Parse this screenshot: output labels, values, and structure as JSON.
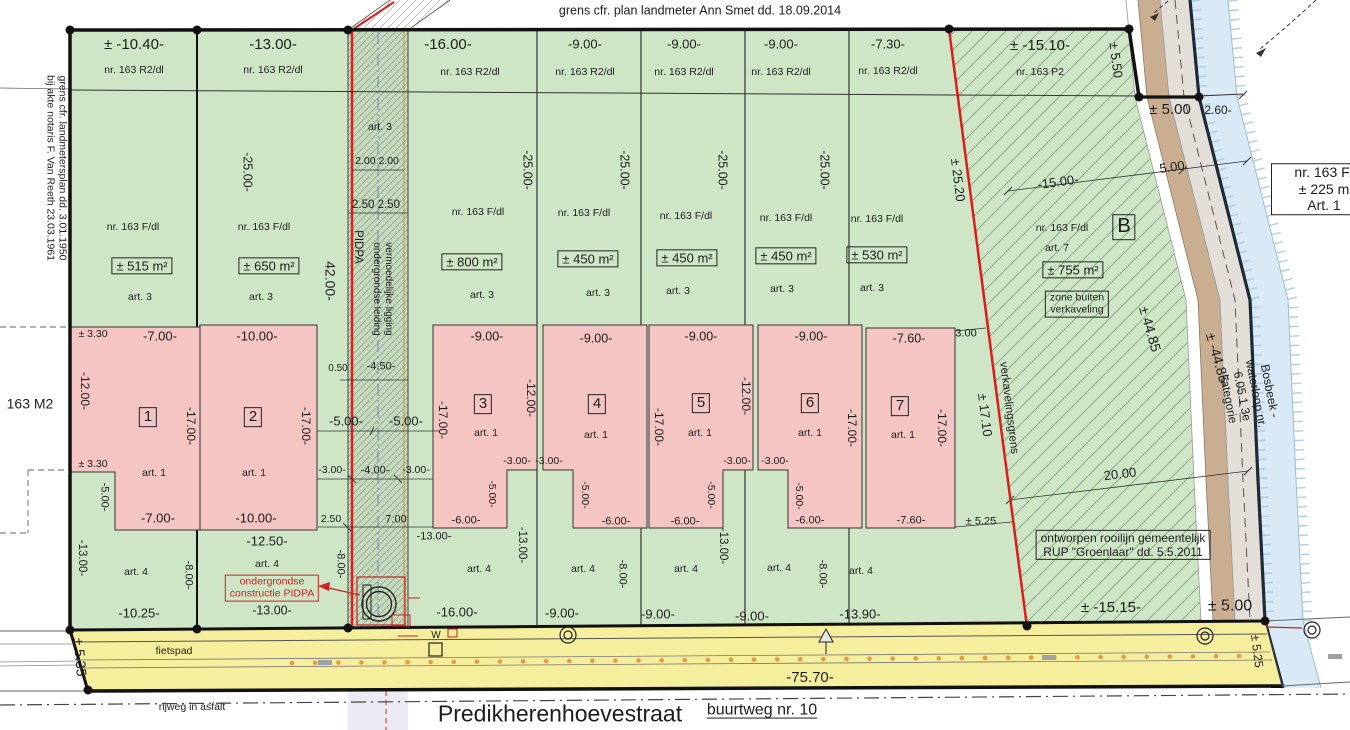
{
  "title": "verkavelingsplan Predikherenhoevestraat",
  "street": {
    "name": "Predikherenhoevestraat",
    "buurtweg": "buurtweg nr. 10",
    "fietspad": "fietspad",
    "rijweg": "rijweg in asfalt",
    "road_length_label": "-75.70-"
  },
  "notes": {
    "top_boundary": "grens cfr. plan landmeter Ann Smet dd. 18.09.2014",
    "left_boundary": "grens cfr. landmetersplan dd. 3.01.1950 bij akte notaris F. Van Reeth 23.03.1961",
    "rooilijn": "ontworpen rooilijn gemeentelijk RUP \"Groenlaar\" dd. 5.5.2011",
    "pidpa_construction": "ondergrondse constructie PIDPA",
    "pidpa_strip": "vermoedelijke ligging ondergrondse leiding PIDPA",
    "waterway": "Bosbeek - waterloop nr. 6.05.1 3e kategorie",
    "subdivision_boundary": "verkavelingsgrens",
    "zone_b": "zone buiten verkaveling"
  },
  "parcels": [
    {
      "lot": "1",
      "area": "± 515 m²",
      "cadastral": "nr. 163 R2/dl / nr. 163 F/dl",
      "front_width": "± -10.40-",
      "house_zoning": "art. 1"
    },
    {
      "lot": "2",
      "area": "± 650 m²",
      "cadastral": "nr. 163 R2/dl / nr. 163 F/dl",
      "front_width": "-13.00-",
      "house_zoning": "art. 1"
    },
    {
      "lot": "3",
      "area": "± 800 m²",
      "cadastral": "nr. 163 R2/dl / nr. 163 F/dl",
      "front_width": "-16.00-",
      "house_zoning": "art. 1"
    },
    {
      "lot": "4",
      "area": "± 450 m²",
      "cadastral": "nr. 163 R2/dl / nr. 163 F/dl",
      "front_width": "-9.00-",
      "house_zoning": "art. 1"
    },
    {
      "lot": "5",
      "area": "± 450 m²",
      "cadastral": "nr. 163 R2/dl / nr. 163 F/dl",
      "front_width": "-9.00-",
      "house_zoning": "art. 1"
    },
    {
      "lot": "6",
      "area": "± 450 m²",
      "cadastral": "nr. 163 R2/dl / nr. 163 F/dl",
      "front_width": "-9.00-",
      "house_zoning": "art. 1"
    },
    {
      "lot": "7",
      "area": "± 530 m²",
      "cadastral": "nr. 163 R2/dl / nr. 163 F/dl",
      "front_width": "-7.30-",
      "house_zoning": "art. 1"
    },
    {
      "lot": "B",
      "area": "± 755 m²",
      "cadastral": "nr. 163 F/dl",
      "zoning": "art. 7",
      "note": "zone buiten verkaveling"
    }
  ],
  "colors": {
    "parcel_green": "#cfe6c6",
    "house_pink": "#f5c5c4",
    "road_yellow": "#f5ee9d",
    "water_blue": "#d9e9f6",
    "path_tan": "#c9ae92",
    "band_gray": "#e3dfd8",
    "boundary_red": "#e01b1b",
    "waterline_navy": "#1d2935",
    "dot_orange": "#e89b3e"
  },
  "labels": [
    {
      "n": "top-boundary-note",
      "t": "grens cfr. plan landmeter Ann Smet dd. 18.09.2014",
      "x": 700,
      "y": 11,
      "s": 12.5
    },
    {
      "t": "± -10.40-",
      "x": 134,
      "y": 45,
      "s": 15
    },
    {
      "t": "-13.00-",
      "x": 273,
      "y": 45,
      "s": 15
    },
    {
      "t": "-16.00-",
      "x": 448,
      "y": 45,
      "s": 15
    },
    {
      "t": "-9.00-",
      "x": 585,
      "y": 44,
      "s": 13
    },
    {
      "t": "-9.00-",
      "x": 684,
      "y": 44,
      "s": 13
    },
    {
      "t": "-9.00-",
      "x": 781,
      "y": 44,
      "s": 13
    },
    {
      "t": "-7.30-",
      "x": 888,
      "y": 44,
      "s": 13
    },
    {
      "t": "± -15.10-",
      "x": 1040,
      "y": 46,
      "s": 15
    },
    {
      "t": "nr. 163 R2/dl",
      "x": 134,
      "y": 70,
      "s": 10.5
    },
    {
      "t": "nr. 163 R2/dl",
      "x": 273,
      "y": 70,
      "s": 10.5
    },
    {
      "t": "nr. 163 R2/dl",
      "x": 470,
      "y": 72,
      "s": 10.5
    },
    {
      "t": "nr. 163 R2/dl",
      "x": 585,
      "y": 72,
      "s": 10.5
    },
    {
      "t": "nr. 163 R2/dl",
      "x": 684,
      "y": 72,
      "s": 10.5
    },
    {
      "t": "nr. 163 R2/dl",
      "x": 781,
      "y": 72,
      "s": 10.5
    },
    {
      "t": "nr. 163 R2/dl",
      "x": 888,
      "y": 71,
      "s": 10.5
    },
    {
      "t": "nr. 163 P2",
      "x": 1040,
      "y": 72,
      "s": 10.5
    },
    {
      "t": "± 5.50",
      "x": 1116,
      "y": 60,
      "r": 83,
      "s": 13
    },
    {
      "t": "± 5.00",
      "x": 1170,
      "y": 110,
      "s": 15
    },
    {
      "t": "2.60-",
      "x": 1218,
      "y": 110,
      "s": 12
    },
    {
      "t": "5.00",
      "x": 1172,
      "y": 167,
      "r": -8,
      "s": 13
    },
    {
      "t": "-15.00-",
      "x": 1058,
      "y": 182,
      "r": -8,
      "s": 13
    },
    {
      "n": "neighbor-parcel-box",
      "t": "nr. 163 F/\n± 225 m\nArt. 1",
      "x": 1324,
      "y": 189,
      "s": 14,
      "b": true,
      "bg": true,
      "w": 96
    },
    {
      "n": "left-boundary-note",
      "t": "grens cfr. landmetersplan dd. 3.01.1950\nbij akte notaris F. Van Reeth 23.03.1961",
      "x": 56,
      "y": 168,
      "r": 90,
      "s": 10.5
    },
    {
      "t": "163 M2",
      "x": 30,
      "y": 404,
      "s": 14
    },
    {
      "t": "-25.00-",
      "x": 247,
      "y": 172,
      "r": 90,
      "s": 12.5
    },
    {
      "t": "-25.00-",
      "x": 527,
      "y": 170,
      "r": 90,
      "s": 12.5
    },
    {
      "t": "-25.00-",
      "x": 624,
      "y": 170,
      "r": 90,
      "s": 12.5
    },
    {
      "t": "-25.00-",
      "x": 722,
      "y": 170,
      "r": 90,
      "s": 12.5
    },
    {
      "t": "-25.00-",
      "x": 824,
      "y": 170,
      "r": 90,
      "s": 12.5
    },
    {
      "t": "42.00-",
      "x": 330,
      "y": 281,
      "r": 90,
      "s": 14
    },
    {
      "t": "art. 3",
      "x": 380,
      "y": 127,
      "s": 10.5
    },
    {
      "t": "2.00 2.00",
      "x": 377,
      "y": 161,
      "s": 10.5
    },
    {
      "t": "2.50 2.50",
      "x": 376,
      "y": 206,
      "s": 11.5
    },
    {
      "t": "PIDPA",
      "x": 357,
      "y": 247,
      "r": 90,
      "s": 11.5
    },
    {
      "t": "vermoedelijke ligging\nondergrondse leiding",
      "x": 382,
      "y": 289,
      "r": 90,
      "s": 10
    },
    {
      "t": "0.50",
      "x": 338,
      "y": 369,
      "s": 10
    },
    {
      "t": "-4.50-",
      "x": 381,
      "y": 367,
      "s": 11
    },
    {
      "t": "-5.00-",
      "x": 346,
      "y": 421,
      "s": 13
    },
    {
      "t": "-5.00-",
      "x": 406,
      "y": 421,
      "s": 13
    },
    {
      "t": "-3.00-",
      "x": 332,
      "y": 470,
      "s": 10.5
    },
    {
      "t": "-4.00-",
      "x": 375,
      "y": 471,
      "s": 11
    },
    {
      "t": "-3.00-",
      "x": 416,
      "y": 470,
      "s": 10.5
    },
    {
      "t": "2.50",
      "x": 331,
      "y": 519,
      "s": 10.5
    },
    {
      "t": "7.00",
      "x": 396,
      "y": 520,
      "s": 11
    },
    {
      "t": "-13.00-",
      "x": 434,
      "y": 537,
      "s": 11
    },
    {
      "n": "pidpa-note",
      "t": "ondergrondse\nconstructie PIDPA",
      "x": 272,
      "y": 588,
      "s": 10.5,
      "c": "red",
      "b": true
    },
    {
      "t": "-8.00-",
      "x": 340,
      "y": 564,
      "r": 90,
      "s": 11
    },
    {
      "t": "nr. 163 F/dl",
      "x": 133,
      "y": 227,
      "s": 10.5
    },
    {
      "t": "nr. 163 F/dl",
      "x": 264,
      "y": 227,
      "s": 10.5
    },
    {
      "t": "nr. 163 F/dl",
      "x": 478,
      "y": 212,
      "s": 10.5
    },
    {
      "t": "nr. 163 F/dl",
      "x": 584,
      "y": 213,
      "s": 10.5
    },
    {
      "t": "nr. 163 F/dl",
      "x": 686,
      "y": 216,
      "s": 10.5
    },
    {
      "t": "nr. 163 F/dl",
      "x": 786,
      "y": 218,
      "s": 10.5
    },
    {
      "t": "nr. 163 F/dl",
      "x": 877,
      "y": 219,
      "s": 10.5
    },
    {
      "n": "area-label",
      "t": "± 515 m²",
      "x": 142,
      "y": 266,
      "s": 13,
      "b": true
    },
    {
      "n": "area-label",
      "t": "± 650 m²",
      "x": 269,
      "y": 266,
      "s": 13,
      "b": true
    },
    {
      "n": "area-label",
      "t": "± 800 m²",
      "x": 472,
      "y": 262,
      "s": 13,
      "b": true
    },
    {
      "n": "area-label",
      "t": "± 450 m²",
      "x": 588,
      "y": 259,
      "s": 13,
      "b": true
    },
    {
      "n": "area-label",
      "t": "± 450 m²",
      "x": 687,
      "y": 258,
      "s": 13,
      "b": true
    },
    {
      "n": "area-label",
      "t": "± 450 m²",
      "x": 786,
      "y": 256,
      "s": 13,
      "b": true
    },
    {
      "n": "area-label",
      "t": "± 530 m²",
      "x": 877,
      "y": 255,
      "s": 13,
      "b": true
    },
    {
      "t": "art. 3",
      "x": 140,
      "y": 297,
      "s": 10.5
    },
    {
      "t": "art. 3",
      "x": 261,
      "y": 297,
      "s": 10.5
    },
    {
      "t": "art. 3",
      "x": 482,
      "y": 295,
      "s": 10.5
    },
    {
      "t": "art. 3",
      "x": 598,
      "y": 293,
      "s": 10.5
    },
    {
      "t": "art. 3",
      "x": 678,
      "y": 291,
      "s": 10.5
    },
    {
      "t": "art. 3",
      "x": 782,
      "y": 289,
      "s": 10.5
    },
    {
      "t": "art. 3",
      "x": 872,
      "y": 288,
      "s": 10.5
    },
    {
      "t": "nr. 163 F/dl",
      "x": 1062,
      "y": 228,
      "s": 10.5
    },
    {
      "t": "art. 7",
      "x": 1057,
      "y": 248,
      "s": 10.5
    },
    {
      "n": "area-label",
      "t": "± 755 m²",
      "x": 1073,
      "y": 270,
      "s": 13,
      "b": true
    },
    {
      "n": "parcel-b-label",
      "t": "B",
      "x": 1124,
      "y": 227,
      "s": 20,
      "b": true
    },
    {
      "n": "zone-note",
      "t": "zone buiten\nverkaveling",
      "x": 1077,
      "y": 304,
      "s": 10.5,
      "b": true
    },
    {
      "t": "± 3.30",
      "x": 93,
      "y": 334,
      "s": 10.5
    },
    {
      "t": "± 3.30",
      "x": 93,
      "y": 464,
      "s": 10.5
    },
    {
      "t": "-7.00-",
      "x": 160,
      "y": 336,
      "s": 13
    },
    {
      "t": "-10.00-",
      "x": 257,
      "y": 336,
      "s": 13
    },
    {
      "t": "-9.00-",
      "x": 487,
      "y": 337,
      "s": 12.5
    },
    {
      "t": "-9.00-",
      "x": 596,
      "y": 339,
      "s": 12.5
    },
    {
      "t": "-9.00-",
      "x": 701,
      "y": 337,
      "s": 12.5
    },
    {
      "t": "-9.00-",
      "x": 811,
      "y": 337,
      "s": 12.5
    },
    {
      "t": "-7.60-",
      "x": 909,
      "y": 339,
      "s": 12.5
    },
    {
      "t": "3.00",
      "x": 966,
      "y": 334,
      "s": 11
    },
    {
      "t": "-12.00-",
      "x": 85,
      "y": 391,
      "r": 90,
      "s": 12
    },
    {
      "t": "-12.00-",
      "x": 531,
      "y": 398,
      "r": 90,
      "s": 12
    },
    {
      "t": "-12.00-",
      "x": 746,
      "y": 396,
      "r": 90,
      "s": 12
    },
    {
      "n": "lot-number",
      "t": "1",
      "x": 148,
      "y": 417,
      "s": 15,
      "b": true
    },
    {
      "n": "lot-number",
      "t": "2",
      "x": 253,
      "y": 417,
      "s": 15,
      "b": true
    },
    {
      "n": "lot-number",
      "t": "3",
      "x": 483,
      "y": 404,
      "s": 15,
      "b": true
    },
    {
      "n": "lot-number",
      "t": "4",
      "x": 597,
      "y": 404,
      "s": 15,
      "b": true
    },
    {
      "n": "lot-number",
      "t": "5",
      "x": 701,
      "y": 403,
      "s": 15,
      "b": true
    },
    {
      "n": "lot-number",
      "t": "6",
      "x": 810,
      "y": 403,
      "s": 15,
      "b": true
    },
    {
      "n": "lot-number",
      "t": "7",
      "x": 900,
      "y": 406,
      "s": 15,
      "b": true
    },
    {
      "t": "-17.00-",
      "x": 191,
      "y": 426,
      "r": 90,
      "s": 12
    },
    {
      "t": "-17.00-",
      "x": 306,
      "y": 426,
      "r": 90,
      "s": 12
    },
    {
      "t": "-17.00-",
      "x": 443,
      "y": 420,
      "r": 90,
      "s": 12
    },
    {
      "t": "-17.00-",
      "x": 659,
      "y": 427,
      "r": 90,
      "s": 12
    },
    {
      "t": "-17.00-",
      "x": 852,
      "y": 428,
      "r": 90,
      "s": 12
    },
    {
      "t": "-17.00-",
      "x": 942,
      "y": 428,
      "r": 90,
      "s": 12
    },
    {
      "t": "art. 1",
      "x": 154,
      "y": 473,
      "s": 10.5
    },
    {
      "t": "art. 1",
      "x": 254,
      "y": 473,
      "s": 10.5
    },
    {
      "t": "art. 1",
      "x": 486,
      "y": 433,
      "s": 10.5
    },
    {
      "t": "art. 1",
      "x": 596,
      "y": 435,
      "s": 10.5
    },
    {
      "t": "art. 1",
      "x": 700,
      "y": 433,
      "s": 10.5
    },
    {
      "t": "art. 1",
      "x": 810,
      "y": 433,
      "s": 10.5
    },
    {
      "t": "art. 1",
      "x": 903,
      "y": 435,
      "s": 10.5
    },
    {
      "t": "-5.00-",
      "x": 104,
      "y": 497,
      "r": 90,
      "s": 11
    },
    {
      "t": "-5.00-",
      "x": 492,
      "y": 494,
      "r": 90,
      "s": 10.5
    },
    {
      "t": "-5.00-",
      "x": 585,
      "y": 495,
      "r": 90,
      "s": 10.5
    },
    {
      "t": "-5.00-",
      "x": 711,
      "y": 495,
      "r": 90,
      "s": 10.5
    },
    {
      "t": "-5.00-",
      "x": 799,
      "y": 496,
      "r": 90,
      "s": 10.5
    },
    {
      "t": "-3.00-",
      "x": 517,
      "y": 461,
      "s": 10.5
    },
    {
      "t": "-3.00-",
      "x": 549,
      "y": 461,
      "s": 10.5
    },
    {
      "t": "-3.00-",
      "x": 737,
      "y": 461,
      "s": 10.5
    },
    {
      "t": "-3.00-",
      "x": 775,
      "y": 461,
      "s": 10.5
    },
    {
      "t": "-7.00-",
      "x": 158,
      "y": 518,
      "s": 13
    },
    {
      "t": "-10.00-",
      "x": 256,
      "y": 518,
      "s": 13
    },
    {
      "t": "-6.00-",
      "x": 466,
      "y": 521,
      "s": 11
    },
    {
      "t": "-6.00-",
      "x": 616,
      "y": 522,
      "s": 11
    },
    {
      "t": "-6.00-",
      "x": 685,
      "y": 522,
      "s": 11
    },
    {
      "t": "-6.00-",
      "x": 810,
      "y": 521,
      "s": 11
    },
    {
      "t": "-7.60-",
      "x": 911,
      "y": 521,
      "s": 11
    },
    {
      "t": "± 5.25",
      "x": 981,
      "y": 522,
      "s": 11
    },
    {
      "t": "-12.50-",
      "x": 267,
      "y": 541,
      "s": 13
    },
    {
      "t": "± 25.20",
      "x": 958,
      "y": 180,
      "r": 83,
      "s": 13
    },
    {
      "t": "± 17.10",
      "x": 985,
      "y": 415,
      "r": 83,
      "s": 13
    },
    {
      "n": "subdivision-boundary-label",
      "t": "verkavelingsgrens",
      "x": 1008,
      "y": 408,
      "r": 83,
      "s": 11.5
    },
    {
      "t": "± 44.85",
      "x": 1150,
      "y": 329,
      "r": 74,
      "s": 14
    },
    {
      "t": "± -44.85-",
      "x": 1218,
      "y": 360,
      "r": 74,
      "s": 14
    },
    {
      "n": "waterway-label",
      "t": "Bosbeek - waterloop nr. 6.05.1 3e kategorie",
      "x": 1249,
      "y": 395,
      "r": 79,
      "s": 12
    },
    {
      "t": "20.00",
      "x": 1120,
      "y": 474,
      "r": -7,
      "s": 13
    },
    {
      "n": "rooilijn-note",
      "t": "ontworpen rooilijn gemeentelijk\nRUP \"Groenlaar\" dd. 5.5.2011",
      "x": 1123,
      "y": 545,
      "s": 12,
      "b": true
    },
    {
      "t": "± -15.15-",
      "x": 1111,
      "y": 608,
      "s": 15
    },
    {
      "t": "± 5.00",
      "x": 1230,
      "y": 607,
      "s": 16
    },
    {
      "t": "-13.00-",
      "x": 81,
      "y": 558,
      "r": 90,
      "s": 11.5
    },
    {
      "t": "-13.00-",
      "x": 521,
      "y": 545,
      "r": 90,
      "s": 11.5
    },
    {
      "t": "-13.00-",
      "x": 722,
      "y": 546,
      "r": 90,
      "s": 11.5
    },
    {
      "t": "-8.00-",
      "x": 188,
      "y": 575,
      "r": 90,
      "s": 11
    },
    {
      "t": "-8.00-",
      "x": 622,
      "y": 574,
      "r": 90,
      "s": 11
    },
    {
      "t": "-8.00-",
      "x": 822,
      "y": 574,
      "r": 90,
      "s": 11
    },
    {
      "t": "art. 4",
      "x": 136,
      "y": 572,
      "s": 10.5
    },
    {
      "t": "art. 4",
      "x": 267,
      "y": 564,
      "s": 10.5
    },
    {
      "t": "art. 4",
      "x": 479,
      "y": 569,
      "s": 10.5
    },
    {
      "t": "art. 4",
      "x": 583,
      "y": 569,
      "s": 10.5
    },
    {
      "t": "art. 4",
      "x": 686,
      "y": 569,
      "s": 10.5
    },
    {
      "t": "art. 4",
      "x": 779,
      "y": 568,
      "s": 10.5
    },
    {
      "t": "art. 4",
      "x": 861,
      "y": 571,
      "s": 10.5
    },
    {
      "t": "-13.00-",
      "x": 272,
      "y": 611,
      "s": 12.5
    },
    {
      "t": "-10.25-",
      "x": 139,
      "y": 613,
      "s": 13
    },
    {
      "t": "-16.00-",
      "x": 457,
      "y": 612,
      "s": 13
    },
    {
      "t": "-9.00-",
      "x": 562,
      "y": 613,
      "s": 13
    },
    {
      "t": "-9.00-",
      "x": 658,
      "y": 614,
      "s": 13
    },
    {
      "t": "-9.00-",
      "x": 752,
      "y": 616,
      "s": 13
    },
    {
      "t": "-13.90-",
      "x": 860,
      "y": 614,
      "s": 13
    },
    {
      "t": "-75.70-",
      "x": 810,
      "y": 678,
      "s": 15
    },
    {
      "n": "fietspad-label",
      "t": "fietspad",
      "x": 174,
      "y": 651,
      "s": 10.5
    },
    {
      "t": "± 5.35",
      "x": 80,
      "y": 657,
      "r": 85,
      "s": 14
    },
    {
      "t": "± 5.25",
      "x": 1257,
      "y": 651,
      "r": 83,
      "s": 12
    },
    {
      "n": "rijweg-label",
      "t": "rijweg in asfalt",
      "x": 192,
      "y": 707,
      "s": 10.5
    },
    {
      "n": "street-name",
      "t": "Predikherenhoevestraat",
      "x": 560,
      "y": 714,
      "s": 23
    },
    {
      "n": "buurtweg-label",
      "t": "buurtweg nr. 10",
      "x": 762,
      "y": 711,
      "s": 16,
      "u": true
    },
    {
      "t": "W",
      "x": 436,
      "y": 636,
      "s": 10
    }
  ]
}
